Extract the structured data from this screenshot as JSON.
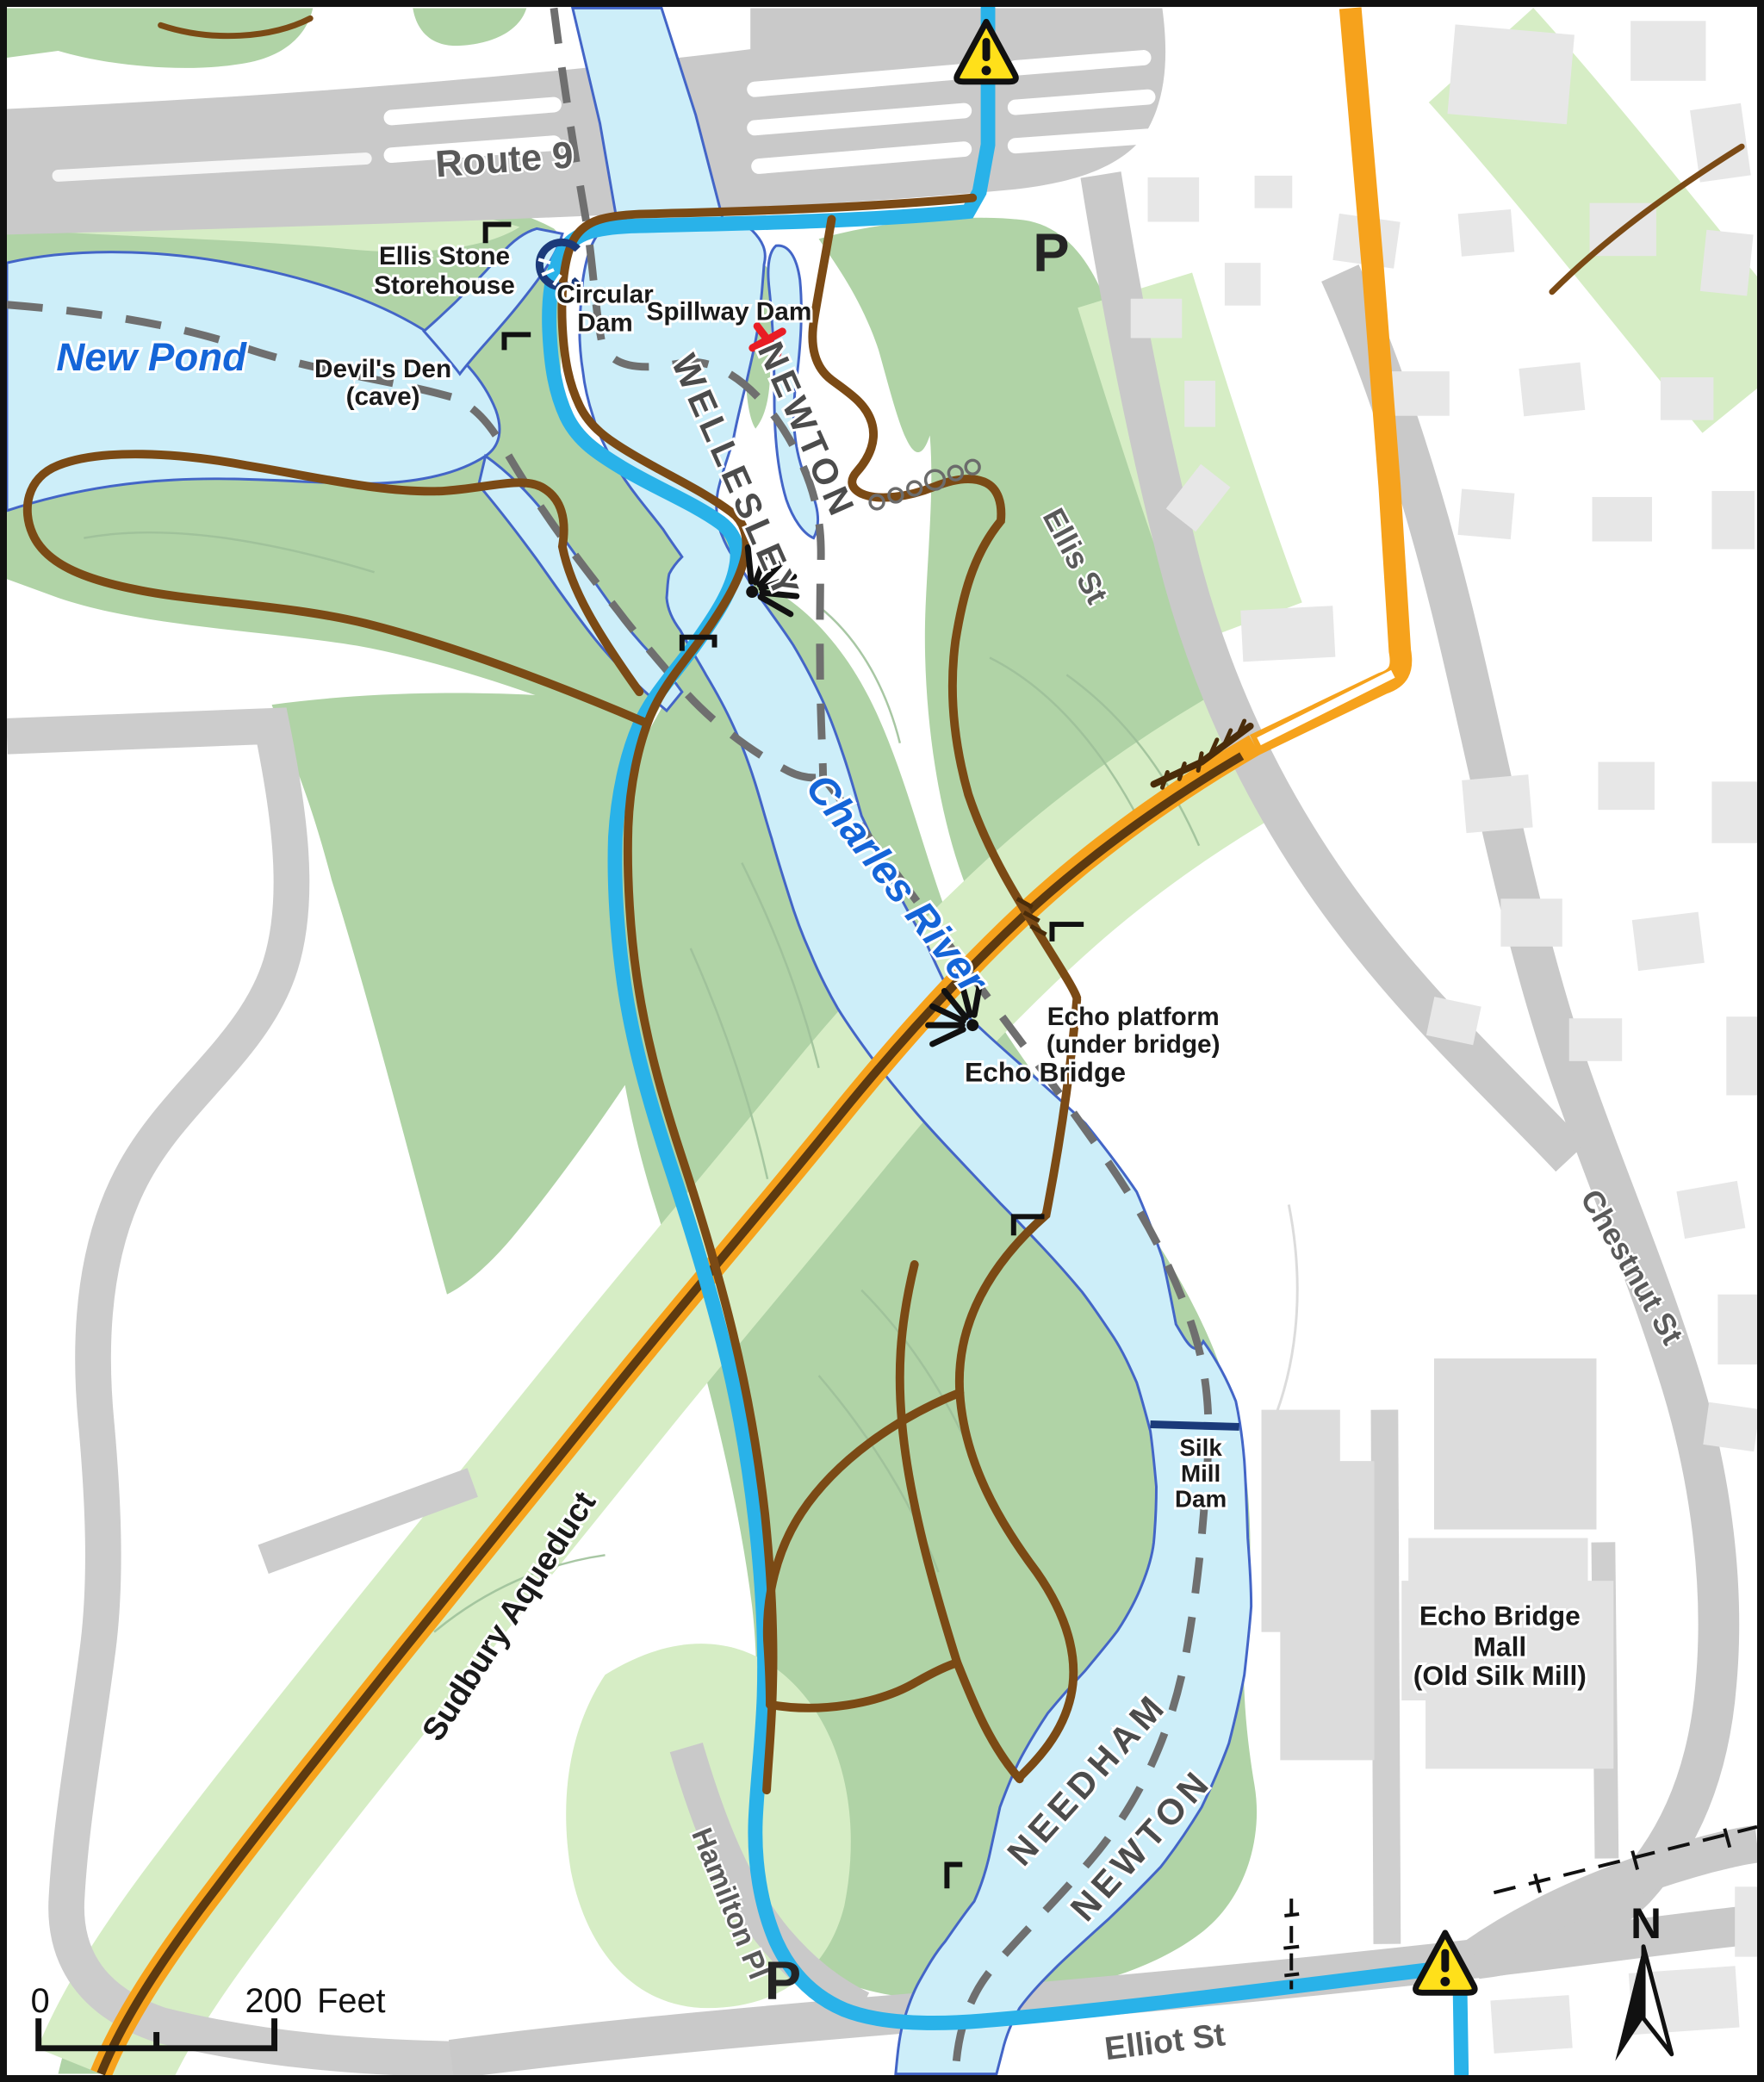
{
  "title": "Echo Bridge / Charles River trail map",
  "colors": {
    "water": "#cdeef9",
    "water_outline": "#4365c7",
    "park_green": "#b0d3a6",
    "light_green": "#d6edc5",
    "road_gray": "#c9c9c9",
    "building_gray": "#e7e7e7",
    "trail_brown": "#7b4a15",
    "trail_blue": "#29b2e9",
    "aqueduct_orange": "#f6a21c",
    "aqueduct_core_brown": "#5d3a10",
    "boundary_gray": "#6f6f6f",
    "dam_navy": "#1b3a7a",
    "warning_yellow": "#ffe01a",
    "marker_red": "#e91d24"
  },
  "roads": {
    "route9": "Route 9",
    "ellis": "Ellis St",
    "chestnut": "Chestnut St",
    "elliot": "Elliot St",
    "hamilton": "Hamilton Pl"
  },
  "water": {
    "new_pond": "New Pond",
    "charles_river": "Charles River"
  },
  "towns": {
    "newton": "NEWTON",
    "wellesley": "WELLESLEY",
    "needham": "NEEDHAM",
    "newton2": "NEWTON"
  },
  "features": {
    "ellis_storehouse": [
      "Ellis Stone",
      "Storehouse"
    ],
    "circular_dam": [
      "Circular",
      "Dam"
    ],
    "spillway_dam": "Spillway Dam",
    "devils_den": [
      "Devil's Den",
      "(cave)"
    ],
    "echo_platform": [
      "Echo platform",
      "(under bridge)"
    ],
    "echo_bridge": "Echo Bridge",
    "silk_mill_dam": [
      "Silk",
      "Mill",
      "Dam"
    ],
    "echo_bridge_mall": [
      "Echo Bridge",
      "Mall",
      "(Old Silk Mill)"
    ],
    "sudbury_aqueduct": "Sudbury Aqueduct"
  },
  "markers": {
    "parking": "P",
    "north": "N"
  },
  "scale": {
    "zero": "0",
    "distance": "200",
    "unit": "Feet"
  }
}
